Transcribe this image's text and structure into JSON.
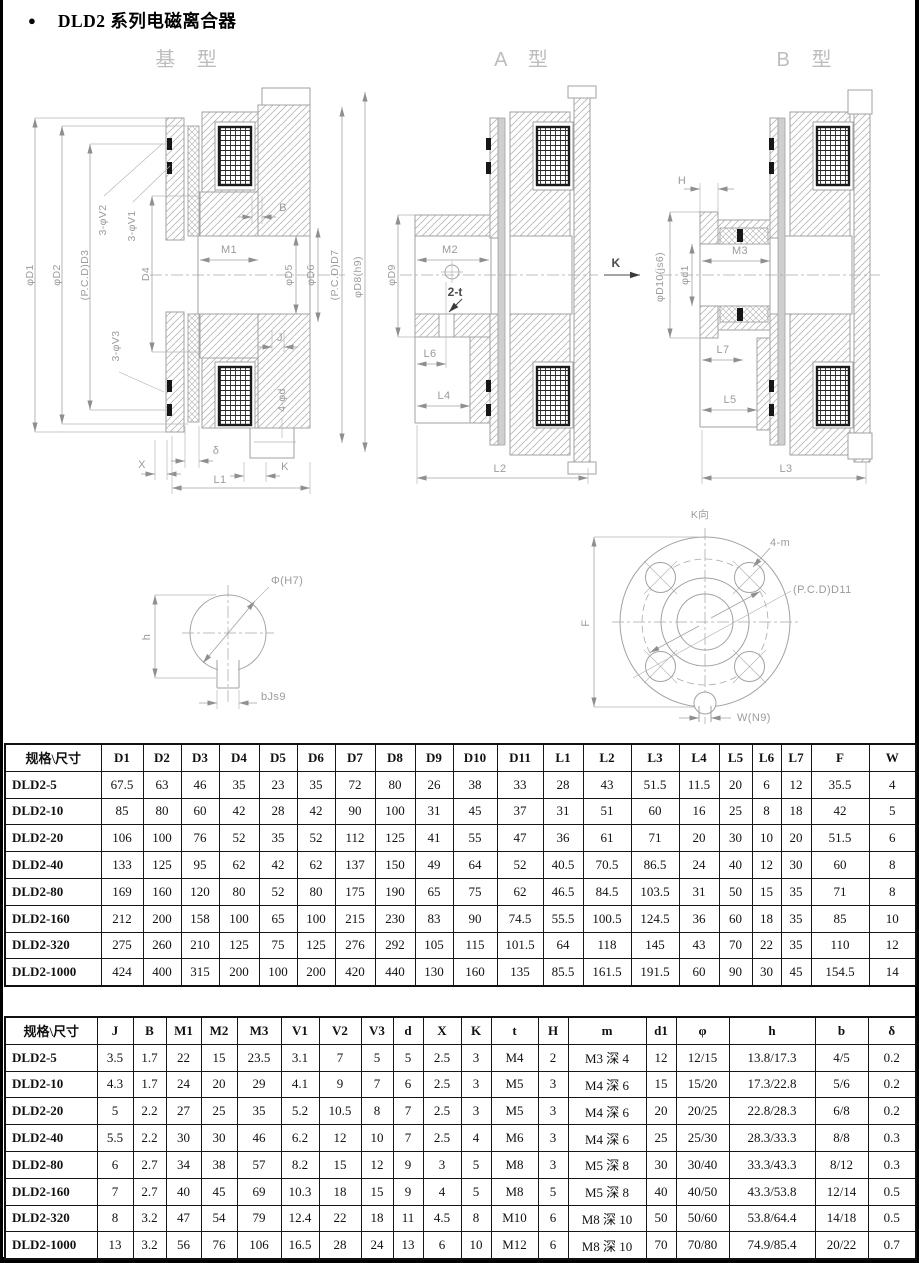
{
  "page": {
    "bullet": "●",
    "title": "DLD2 系列电磁离合器"
  },
  "drawing_titles": {
    "base": "基 型",
    "a": "A 型",
    "b": "B 型"
  },
  "dwg": {
    "base": {
      "d1": "φD1",
      "d2": "φD2",
      "d3": "(P.C.D)D3",
      "v2": "3-φV2",
      "v1": "3-φV1",
      "d4": "D4",
      "m1": "M1",
      "b": "B",
      "j": "J",
      "d5": "φD5",
      "d6": "φD6",
      "d7": "(P.C.D)D7",
      "d8": "φD8(h9)",
      "v3": "3-φV3",
      "fourPhiD": "4-φd",
      "delta": "δ",
      "x": "X",
      "k": "K",
      "l1": "L1"
    },
    "a": {
      "d9": "φD9",
      "m2": "M2",
      "twoT": "2-t",
      "l6": "L6",
      "l4": "L4",
      "l2": "L2",
      "k": "K"
    },
    "b": {
      "h": "H",
      "d10": "φD10(js6)",
      "d1s": "φd1",
      "m3": "M3",
      "l7": "L7",
      "l5": "L5",
      "l3": "L3"
    },
    "keyway": {
      "phi": "Φ(H7)",
      "h": "h",
      "b": "bJs9"
    },
    "flange": {
      "view": "K向",
      "m": "4-m",
      "pcd": "(P.C.D)D11",
      "f": "F",
      "w": "W(N9)"
    }
  },
  "table1": {
    "headers": [
      "规格\\尺寸",
      "D1",
      "D2",
      "D3",
      "D4",
      "D5",
      "D6",
      "D7",
      "D8",
      "D9",
      "D10",
      "D11",
      "L1",
      "L2",
      "L3",
      "L4",
      "L5",
      "L6",
      "L7",
      "F",
      "W"
    ],
    "rows": [
      [
        "DLD2-5",
        "67.5",
        "63",
        "46",
        "35",
        "23",
        "35",
        "72",
        "80",
        "26",
        "38",
        "33",
        "28",
        "43",
        "51.5",
        "11.5",
        "20",
        "6",
        "12",
        "35.5",
        "4"
      ],
      [
        "DLD2-10",
        "85",
        "80",
        "60",
        "42",
        "28",
        "42",
        "90",
        "100",
        "31",
        "45",
        "37",
        "31",
        "51",
        "60",
        "16",
        "25",
        "8",
        "18",
        "42",
        "5"
      ],
      [
        "DLD2-20",
        "106",
        "100",
        "76",
        "52",
        "35",
        "52",
        "112",
        "125",
        "41",
        "55",
        "47",
        "36",
        "61",
        "71",
        "20",
        "30",
        "10",
        "20",
        "51.5",
        "6"
      ],
      [
        "DLD2-40",
        "133",
        "125",
        "95",
        "62",
        "42",
        "62",
        "137",
        "150",
        "49",
        "64",
        "52",
        "40.5",
        "70.5",
        "86.5",
        "24",
        "40",
        "12",
        "30",
        "60",
        "8"
      ],
      [
        "DLD2-80",
        "169",
        "160",
        "120",
        "80",
        "52",
        "80",
        "175",
        "190",
        "65",
        "75",
        "62",
        "46.5",
        "84.5",
        "103.5",
        "31",
        "50",
        "15",
        "35",
        "71",
        "8"
      ],
      [
        "DLD2-160",
        "212",
        "200",
        "158",
        "100",
        "65",
        "100",
        "215",
        "230",
        "83",
        "90",
        "74.5",
        "55.5",
        "100.5",
        "124.5",
        "36",
        "60",
        "18",
        "35",
        "85",
        "10"
      ],
      [
        "DLD2-320",
        "275",
        "260",
        "210",
        "125",
        "75",
        "125",
        "276",
        "292",
        "105",
        "115",
        "101.5",
        "64",
        "118",
        "145",
        "43",
        "70",
        "22",
        "35",
        "110",
        "12"
      ],
      [
        "DLD2-1000",
        "424",
        "400",
        "315",
        "200",
        "100",
        "200",
        "420",
        "440",
        "130",
        "160",
        "135",
        "85.5",
        "161.5",
        "191.5",
        "60",
        "90",
        "30",
        "45",
        "154.5",
        "14"
      ]
    ]
  },
  "table2": {
    "headers": [
      "规格\\尺寸",
      "J",
      "B",
      "M1",
      "M2",
      "M3",
      "V1",
      "V2",
      "V3",
      "d",
      "X",
      "K",
      "t",
      "H",
      "m",
      "d1",
      "φ",
      "h",
      "b",
      "δ"
    ],
    "rows": [
      [
        "DLD2-5",
        "3.5",
        "1.7",
        "22",
        "15",
        "23.5",
        "3.1",
        "7",
        "5",
        "5",
        "2.5",
        "3",
        "M4",
        "2",
        "M3 深 4",
        "12",
        "12/15",
        "13.8/17.3",
        "4/5",
        "0.2"
      ],
      [
        "DLD2-10",
        "4.3",
        "1.7",
        "24",
        "20",
        "29",
        "4.1",
        "9",
        "7",
        "6",
        "2.5",
        "3",
        "M5",
        "3",
        "M4 深 6",
        "15",
        "15/20",
        "17.3/22.8",
        "5/6",
        "0.2"
      ],
      [
        "DLD2-20",
        "5",
        "2.2",
        "27",
        "25",
        "35",
        "5.2",
        "10.5",
        "8",
        "7",
        "2.5",
        "3",
        "M5",
        "3",
        "M4 深 6",
        "20",
        "20/25",
        "22.8/28.3",
        "6/8",
        "0.2"
      ],
      [
        "DLD2-40",
        "5.5",
        "2.2",
        "30",
        "30",
        "46",
        "6.2",
        "12",
        "10",
        "7",
        "2.5",
        "4",
        "M6",
        "3",
        "M4 深 6",
        "25",
        "25/30",
        "28.3/33.3",
        "8/8",
        "0.3"
      ],
      [
        "DLD2-80",
        "6",
        "2.7",
        "34",
        "38",
        "57",
        "8.2",
        "15",
        "12",
        "9",
        "3",
        "5",
        "M8",
        "3",
        "M5 深 8",
        "30",
        "30/40",
        "33.3/43.3",
        "8/12",
        "0.3"
      ],
      [
        "DLD2-160",
        "7",
        "2.7",
        "40",
        "45",
        "69",
        "10.3",
        "18",
        "15",
        "9",
        "4",
        "5",
        "M8",
        "5",
        "M5 深 8",
        "40",
        "40/50",
        "43.3/53.8",
        "12/14",
        "0.5"
      ],
      [
        "DLD2-320",
        "8",
        "3.2",
        "47",
        "54",
        "79",
        "12.4",
        "22",
        "18",
        "11",
        "4.5",
        "8",
        "M10",
        "6",
        "M8 深 10",
        "50",
        "50/60",
        "53.8/64.4",
        "14/18",
        "0.5"
      ],
      [
        "DLD2-1000",
        "13",
        "3.2",
        "56",
        "76",
        "106",
        "16.5",
        "28",
        "24",
        "13",
        "6",
        "10",
        "M12",
        "6",
        "M8 深 10",
        "70",
        "70/80",
        "74.9/85.4",
        "20/22",
        "0.7"
      ]
    ]
  }
}
